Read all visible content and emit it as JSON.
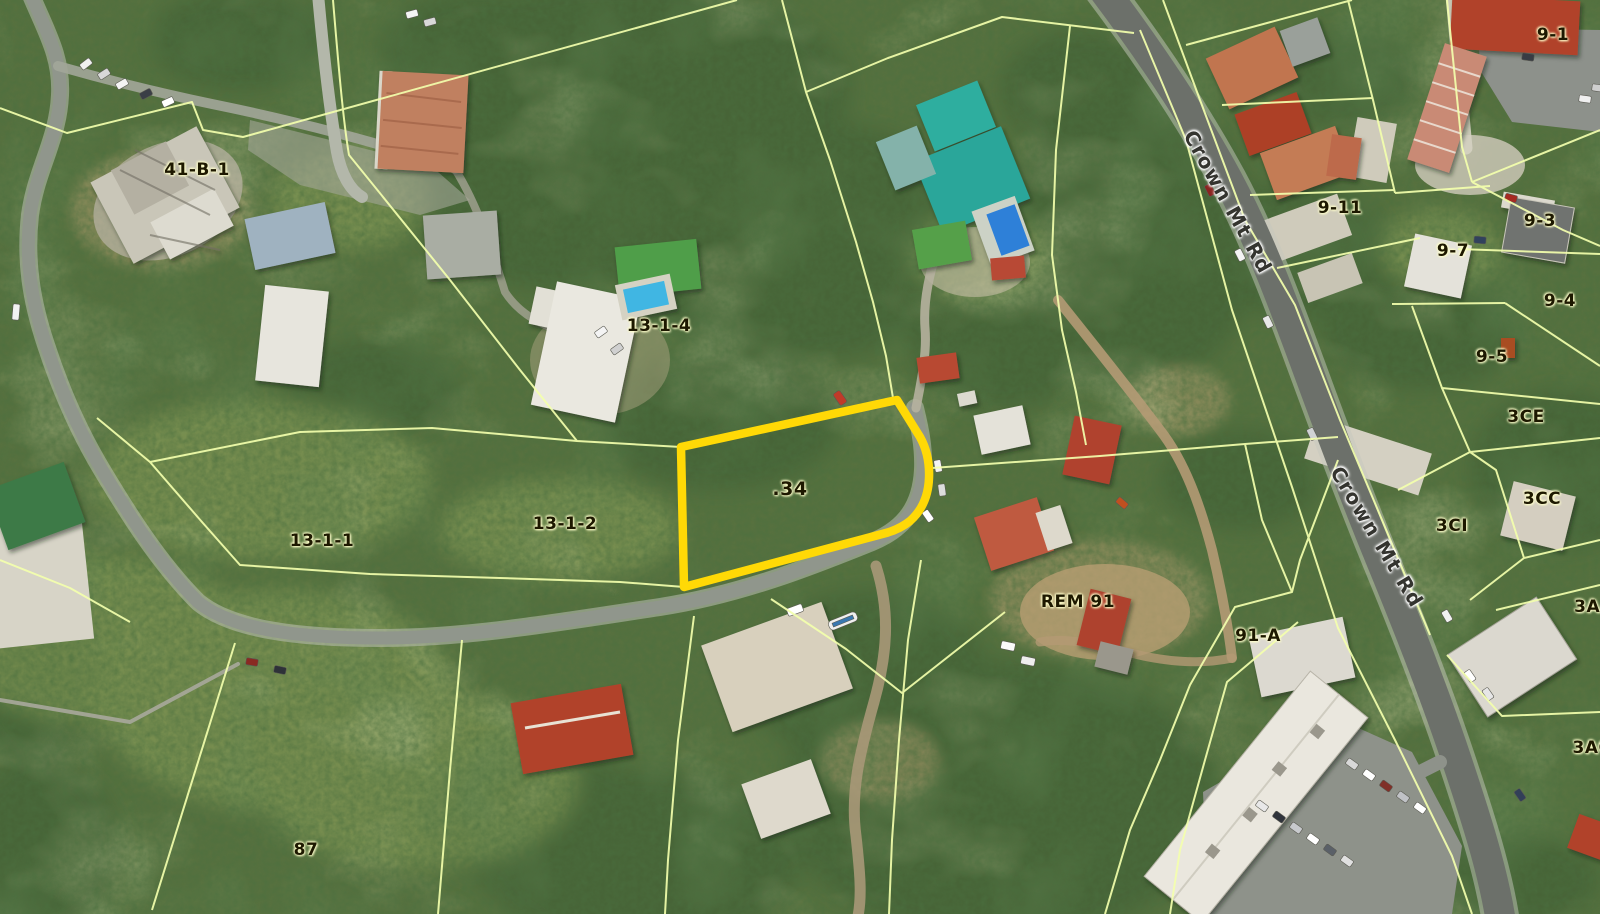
{
  "map": {
    "description": "Aerial satellite view with cadastral parcel boundaries",
    "road_name": "Crown Mt Rd",
    "highlight": {
      "label": ".34",
      "outline_color": "#FFD906"
    },
    "colors": {
      "parcel_line": "#F3FFAD",
      "highlight_outline": "#FFD906",
      "label_text": "#1D1800",
      "road_label_text": "#34342F"
    },
    "labels": [
      {
        "id": "41-B-1",
        "text": "41-B-1",
        "x": 197,
        "y": 170,
        "kind": "parcel"
      },
      {
        "id": "13-1-4",
        "text": "13-1-4",
        "x": 659,
        "y": 326,
        "kind": "parcel"
      },
      {
        "id": "13-1-1",
        "text": "13-1-1",
        "x": 322,
        "y": 541,
        "kind": "parcel"
      },
      {
        "id": "13-1-2",
        "text": "13-1-2",
        "x": 565,
        "y": 524,
        "kind": "parcel"
      },
      {
        "id": "dot-34",
        "text": ".34",
        "x": 790,
        "y": 489,
        "kind": "highlight"
      },
      {
        "id": "87",
        "text": "87",
        "x": 306,
        "y": 850,
        "kind": "parcel"
      },
      {
        "id": "REM-91",
        "text": "REM 91",
        "x": 1078,
        "y": 602,
        "kind": "parcel"
      },
      {
        "id": "91-A",
        "text": "91-A",
        "x": 1258,
        "y": 636,
        "kind": "parcel"
      },
      {
        "id": "9-1",
        "text": "9-1",
        "x": 1553,
        "y": 35,
        "kind": "parcel"
      },
      {
        "id": "9-11",
        "text": "9-11",
        "x": 1340,
        "y": 208,
        "kind": "parcel"
      },
      {
        "id": "9-3",
        "text": "9-3",
        "x": 1540,
        "y": 221,
        "kind": "parcel"
      },
      {
        "id": "9-7",
        "text": "9-7",
        "x": 1453,
        "y": 251,
        "kind": "parcel"
      },
      {
        "id": "9-4",
        "text": "9-4",
        "x": 1560,
        "y": 301,
        "kind": "parcel"
      },
      {
        "id": "9-5",
        "text": "9-5",
        "x": 1492,
        "y": 357,
        "kind": "parcel"
      },
      {
        "id": "3CE",
        "text": "3CE",
        "x": 1526,
        "y": 417,
        "kind": "parcel"
      },
      {
        "id": "3CI",
        "text": "3CI",
        "x": 1452,
        "y": 526,
        "kind": "parcel"
      },
      {
        "id": "3CC",
        "text": "3CC",
        "x": 1542,
        "y": 499,
        "kind": "parcel"
      },
      {
        "id": "3AA",
        "text": "3AA",
        "x": 1594,
        "y": 607,
        "kind": "parcel"
      },
      {
        "id": "3AC",
        "text": "3AC",
        "x": 1592,
        "y": 748,
        "kind": "parcel"
      },
      {
        "id": "crown-mt-rd-north",
        "text": "Crown Mt Rd",
        "x": 1228,
        "y": 202,
        "rot": 61,
        "kind": "road"
      },
      {
        "id": "crown-mt-rd-south",
        "text": "Crown Mt Rd",
        "x": 1377,
        "y": 537,
        "rot": 59,
        "kind": "road"
      }
    ]
  }
}
